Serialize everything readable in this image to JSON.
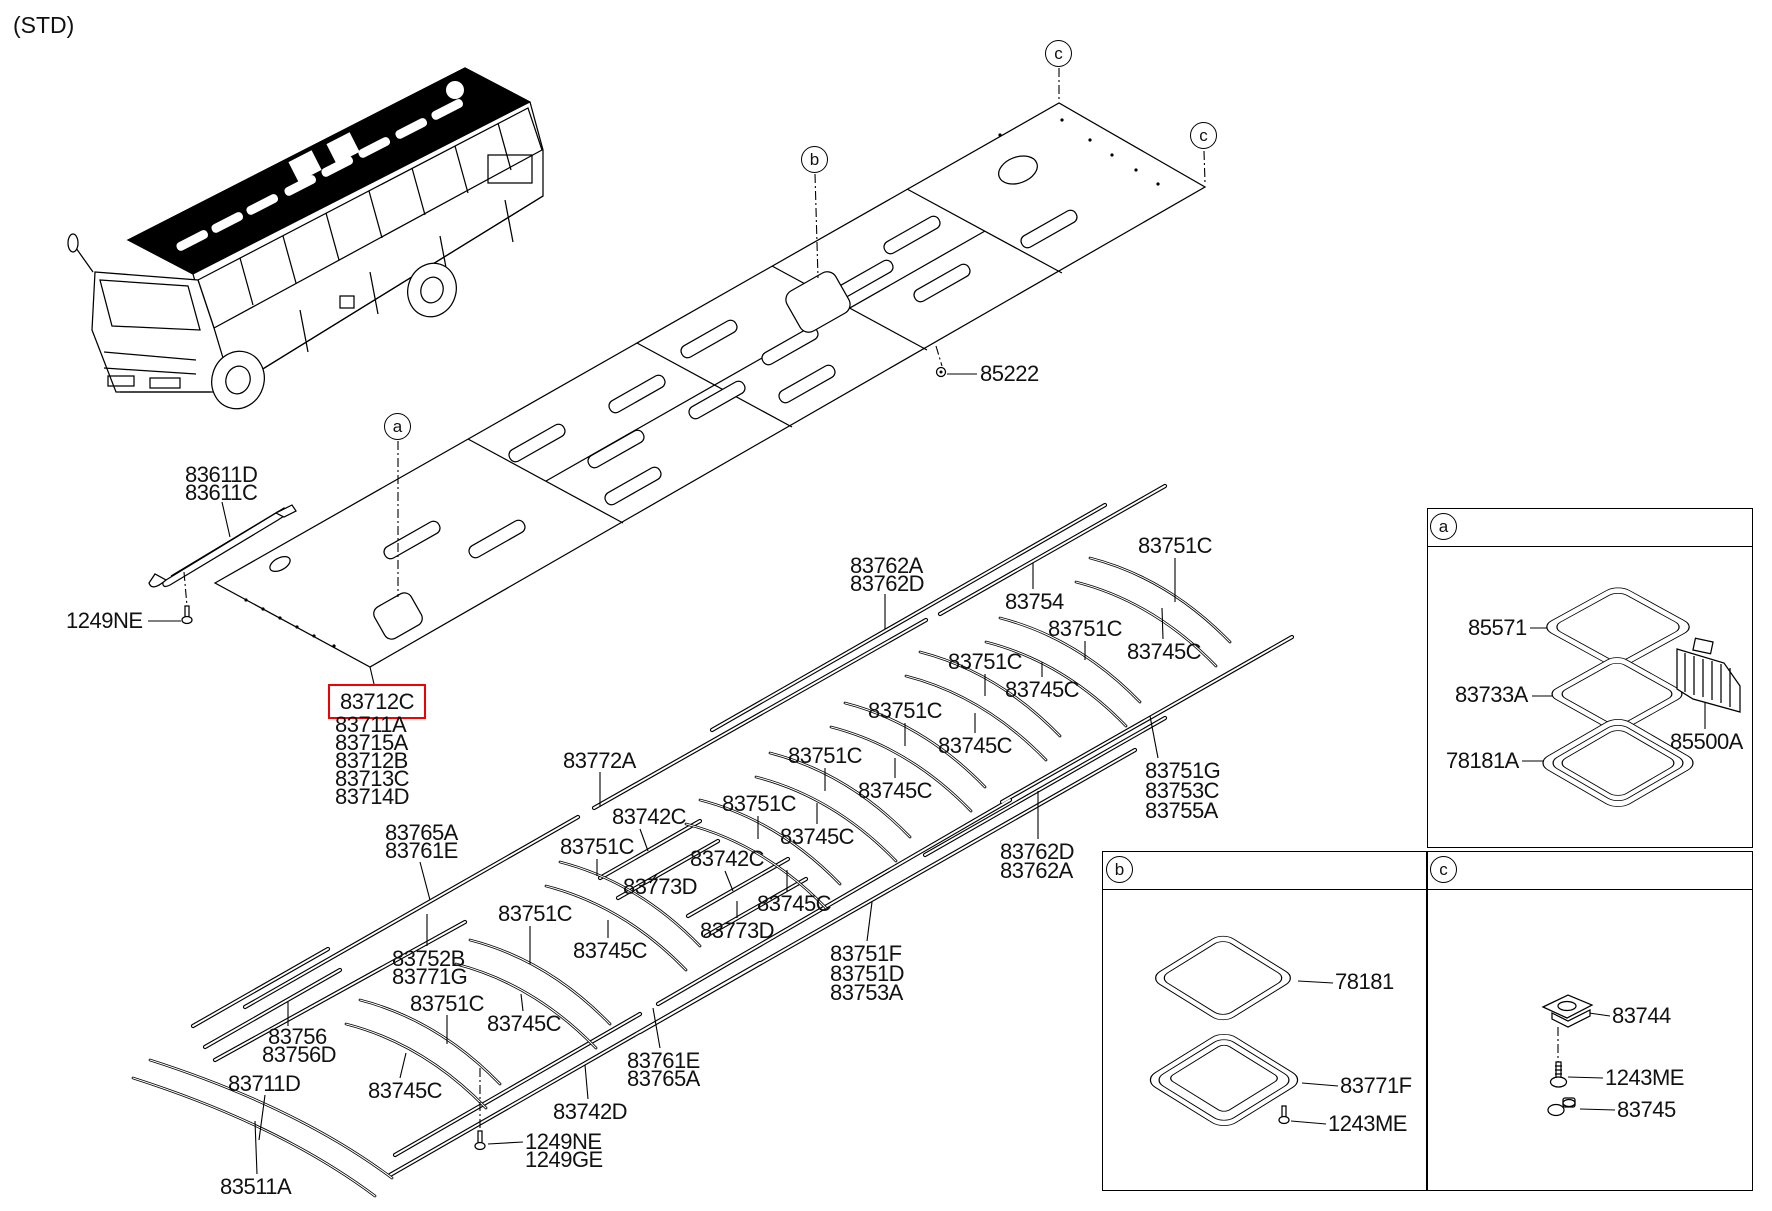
{
  "std_tag": "(STD)",
  "highlight": {
    "part": "83712C",
    "color": "#f40000"
  },
  "callouts": {
    "a": "a",
    "b": "b",
    "c": "c"
  },
  "labels": {
    "l83611D": "83611D",
    "l83611C": "83611C",
    "l1249NE_a": "1249NE",
    "l83712C": "83712C",
    "l83711A": "83711A",
    "l83715A": "83715A",
    "l83712B": "83712B",
    "l83713C": "83713C",
    "l83714D": "83714D",
    "l83765A_a": "83765A",
    "l83761E_a": "83761E",
    "l83772A": "83772A",
    "l83742C_1": "83742C",
    "l83742C_2": "83742C",
    "l83773D_1": "83773D",
    "l83773D_2": "83773D",
    "l83751C_1": "83751C",
    "l83751C_2": "83751C",
    "l83751C_3": "83751C",
    "l83751C_4": "83751C",
    "l83751C_5": "83751C",
    "l83751C_6": "83751C",
    "l83751C_7": "83751C",
    "l83751C_8": "83751C",
    "l83751C_9": "83751C",
    "l83745C_1": "83745C",
    "l83745C_2": "83745C",
    "l83745C_3": "83745C",
    "l83745C_4": "83745C",
    "l83745C_5": "83745C",
    "l83745C_6": "83745C",
    "l83745C_7": "83745C",
    "l83745C_8": "83745C",
    "l83745C_9": "83745C",
    "l83754": "83754",
    "l83762A_a": "83762A",
    "l83762D_a": "83762D",
    "l83762D_b": "83762D",
    "l83762A_b": "83762A",
    "l83751G": "83751G",
    "l83753C": "83753C",
    "l83755A": "83755A",
    "l83751F": "83751F",
    "l83751D": "83751D",
    "l83753A": "83753A",
    "l83752B": "83752B",
    "l83771G": "83771G",
    "l83756": "83756",
    "l83756D": "83756D",
    "l83711D": "83711D",
    "l83511A": "83511A",
    "l83742D": "83742D",
    "l1249NE_b": "1249NE",
    "l1249GE": "1249GE",
    "l83761E_b": "83761E",
    "l83765A_b": "83765A",
    "l85222": "85222",
    "l85571": "85571",
    "l83733A": "83733A",
    "l78181A": "78181A",
    "l85500A": "85500A",
    "l78181": "78181",
    "l83771F": "83771F",
    "l1243ME_b": "1243ME",
    "l83744": "83744",
    "l1243ME_c": "1243ME",
    "l83745": "83745"
  }
}
